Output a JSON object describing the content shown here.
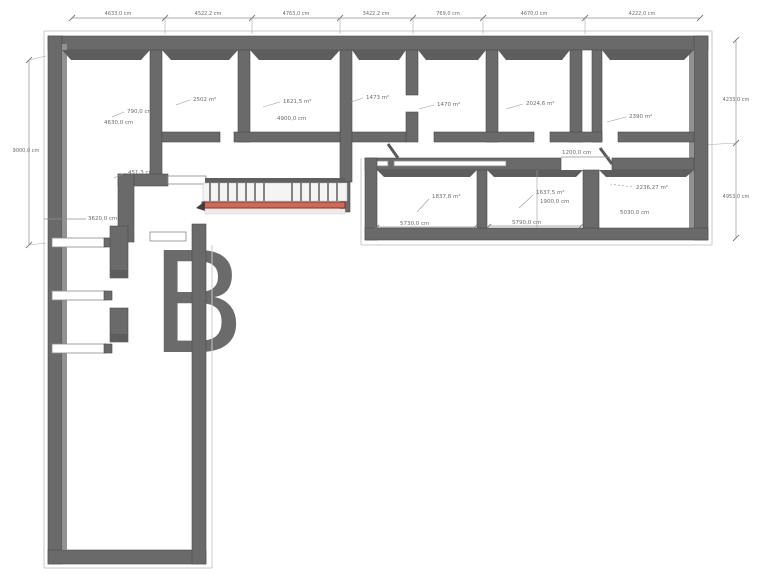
{
  "document": {
    "type": "3d-floor-plan-top-view",
    "units": "cm"
  },
  "colors": {
    "wall": "#6a6a6a",
    "wall_edge": "#4c4c4c",
    "wall_inner_face": "#929292",
    "dimension_line": "#8f8f8f",
    "label_text": "#6b6b6b",
    "stair_red_fill": "#cd6a5c",
    "stair_red_edge": "#8e2f23",
    "watermark": "#ececec",
    "background": "#ffffff"
  },
  "top_dims": [
    "4633,0 cm",
    "4522,2 cm",
    "4763,0 cm",
    "3422,2 cm",
    "769,0 cm",
    "4670,0 cm",
    "4222,0 cm"
  ],
  "left_dims": {
    "total_height": "9000,0 cm",
    "hall_opening": "451,3 cm",
    "wing_width": "3620,0 cm"
  },
  "right_dims": {
    "upper": "4233,0 cm",
    "lower": "4953,0 cm"
  },
  "corridor_opening": "1200,0 cm",
  "rooms": {
    "room1": {
      "width": "790,0 cm",
      "depth": "4630,0 cm"
    },
    "room2": {
      "area": "2502 m²"
    },
    "room3": {
      "area": "1621,5 m²",
      "depth": "4900,0 cm"
    },
    "room4": {
      "area": "1473 m²"
    },
    "room5": {
      "area": "1470 m²"
    },
    "room6": {
      "area": "2024,6 m²"
    },
    "room7": {
      "area": "2390 m²"
    },
    "roomA": {
      "area": "1837,8 m²",
      "width": "5730,0 cm"
    },
    "roomB": {
      "area": "1637,5 m²",
      "inner": "1900,0 cm",
      "width": "5790,0 cm"
    },
    "roomC": {
      "area": "2236,27 m²",
      "width": "5030,0 cm"
    }
  },
  "watermark_glyph": "B"
}
